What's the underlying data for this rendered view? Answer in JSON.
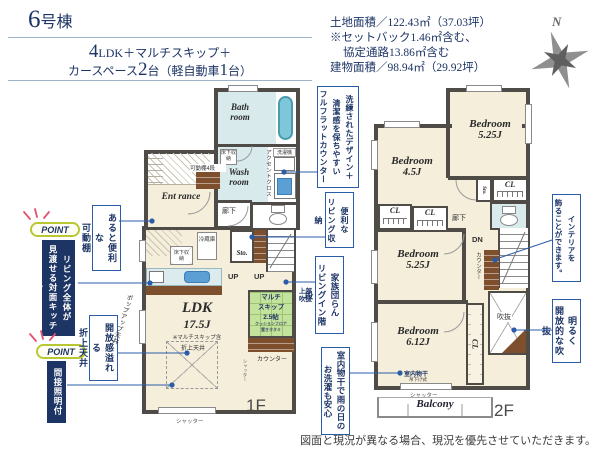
{
  "header": {
    "building_number": "6",
    "building_suffix": "号棟",
    "spec_line1_num": "4",
    "spec_line1_text": "LDK＋マルチスキップ＋",
    "spec_line2_pre": "カースペース",
    "spec_line2_num": "2",
    "spec_line2_mid": "台（軽自動車",
    "spec_line2_num2": "1",
    "spec_line2_end": "台）",
    "area_lines": [
      "土地面積／122.43㎡（37.03坪）",
      "※セットバック1.46㎡含む、",
      "協定通路13.86㎡含む",
      "建物面積／98.94㎡（29.92坪）"
    ],
    "compass": "N"
  },
  "points": {
    "badge1": "POINT",
    "text1": "リビング全体が\n見渡せる対面キッチン",
    "badge2": "POINT",
    "text2": "間接照明付き"
  },
  "callouts": {
    "movable_shelf": "あると便利な\n可動棚",
    "coved_ceiling": "開放感溢れる\n折上天井",
    "flat_counter": "洗練されたデザイン＋\n清潔感を保ちやすい\nフルフラットカウンター",
    "living_storage": "便利な\nリビング収納",
    "living_stairs": "家族団らん\nリビングイン階段",
    "indoor_drying": "室内物干で雨の日の\nお洗濯も安心",
    "interior_decor": "インテリアを\n飾ることができます。",
    "bright_void": "明るく\n開放的な吹抜"
  },
  "floor1": {
    "bath": "Bath room",
    "wash": "Wash room",
    "underfloor_wash": "床下収納",
    "accent_cloth": "アクセントクロス",
    "washer": "洗濯機",
    "movable_shelf4": "可動棚4段",
    "entrance": "Ent rance",
    "hallway": "廊下",
    "fridge": "冷蔵庫",
    "underfloor_kitchen": "床下収納",
    "storage": "Sto.",
    "up1": "UP",
    "up2": "UP",
    "ldk_name": "LDK",
    "ldk_size": "17.5J",
    "ldk_note": "※マルチスキップ含",
    "coved_label": "折上天井",
    "popup_ceiling": "ポップアップ天井",
    "multi_line1": "マルチ",
    "multi_line2": "スキップ",
    "multi_line3": "2.5帖",
    "multi_note1": "クッションフロア",
    "multi_note2": "置きタタミ",
    "upper_void": "上部吹抜",
    "counter": "カウンター",
    "shutter_side": "シャッター",
    "shutter_bottom": "シャッター",
    "label": "1F"
  },
  "floor2": {
    "bed1_name": "Bedroom",
    "bed1_size": "5.25J",
    "bed2_name": "Bedroom",
    "bed2_size": "4.5J",
    "bed3_name": "Bedroom",
    "bed3_size": "5.25J",
    "bed4_name": "Bedroom",
    "bed4_size": "6.12J",
    "cl1": "CL",
    "cl2": "CL",
    "cl3": "CL",
    "cl4": "CL",
    "storage": "Sto.",
    "hallway": "廊下",
    "dn": "DN",
    "counter": "カウンター",
    "void": "吹抜",
    "indoor_drying": "室内物干",
    "drying_sub": "吊下げ式",
    "shutter": "シャッター",
    "balcony": "Balcony",
    "label": "2F"
  },
  "footer": {
    "disclaimer": "図面と現況が異なる場合、現況を優先させていただきます。"
  }
}
